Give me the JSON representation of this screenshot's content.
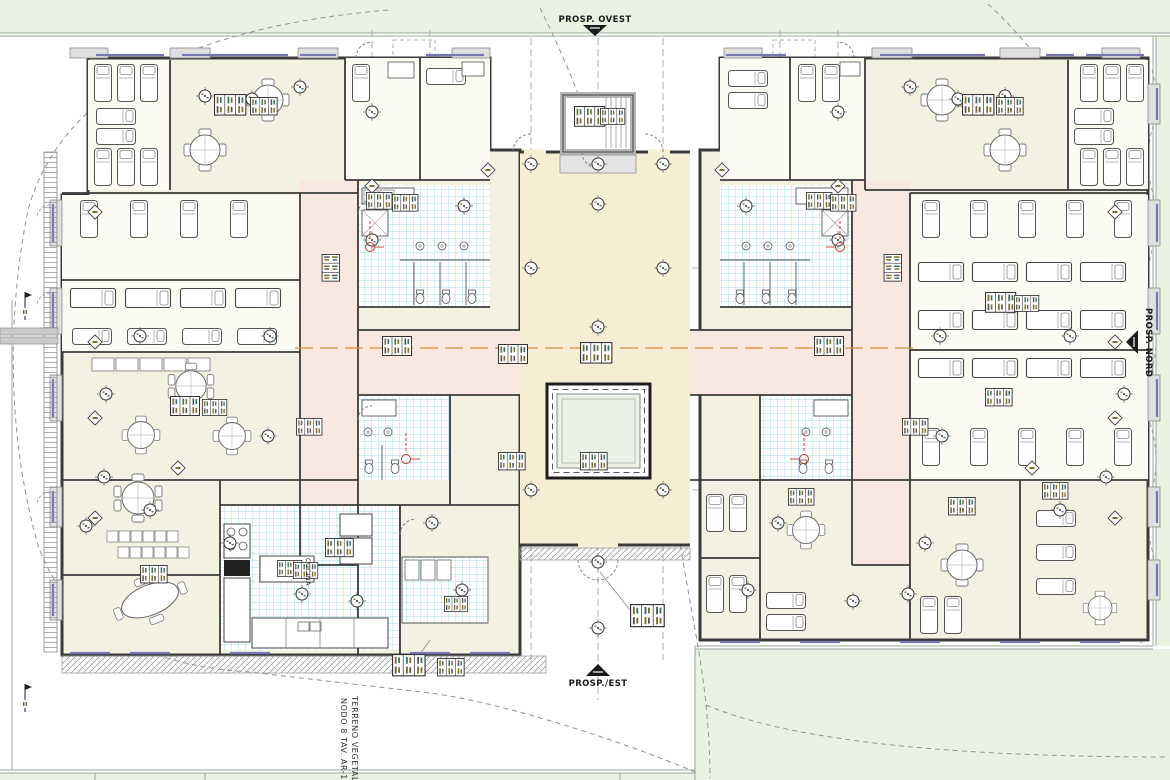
{
  "sheet": {
    "type": "architectural-floor-plan",
    "elevation_markers": {
      "west": "PROSP. OVEST",
      "east": "PROSP./EST",
      "north": "PROSP. NORD"
    },
    "site_notes": {
      "terrain": "TERRENO VEGETALE",
      "node": "NODO 8 TAV. AR-12"
    },
    "room_labels": {
      "kitchen": "CUCINA"
    },
    "colors": {
      "site_green": "#e9f2e1",
      "hall_cream": "#f6eed4",
      "room_cream": "#f3f1e2",
      "room_white": "#fcfbf3",
      "corridor_pink": "#f8e8df",
      "tile_line": "#8ad2d8",
      "wall": "#3b3b3b",
      "window_blue": "#7678b4",
      "safety_red": "#c0392b",
      "section_orange": "#d98e3a",
      "courtyard_green": "#ebf2e5"
    }
  }
}
